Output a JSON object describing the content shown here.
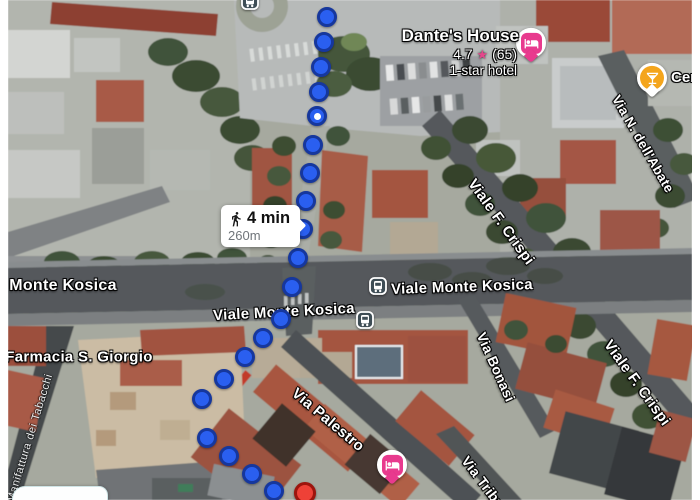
{
  "route": {
    "mode": "walking",
    "duration": "4 min",
    "distance": "260m",
    "dot_fill": "#2a5ff0",
    "dot_border": "#16379d",
    "white_center_dot_index": 4,
    "badge": {
      "x": 221,
      "y": 205
    },
    "dots": [
      [
        327,
        17
      ],
      [
        324,
        42
      ],
      [
        321,
        67
      ],
      [
        319,
        92
      ],
      [
        317,
        116
      ],
      [
        313,
        145
      ],
      [
        310,
        173
      ],
      [
        306,
        201
      ],
      [
        303,
        229
      ],
      [
        298,
        258
      ],
      [
        292,
        287
      ],
      [
        281,
        319
      ],
      [
        263,
        338
      ],
      [
        245,
        357
      ],
      [
        224,
        379
      ],
      [
        202,
        399
      ],
      [
        207,
        438
      ],
      [
        229,
        456
      ],
      [
        252,
        474
      ],
      [
        274,
        491
      ]
    ]
  },
  "destination": {
    "x": 305,
    "y": 493,
    "fill": "#ee4137",
    "border": "#9d140d"
  },
  "street_labels": [
    {
      "text": "Monte Kosica",
      "x": 63,
      "y": 286,
      "rot": 0,
      "size": 16,
      "variant": "road"
    },
    {
      "text": "Viale Monte Kosica",
      "x": 462,
      "y": 287,
      "rot": -2,
      "size": 15,
      "variant": "road"
    },
    {
      "text": "Viale Monte Kosica",
      "x": 284,
      "y": 312,
      "rot": -3,
      "size": 15,
      "variant": "road"
    },
    {
      "text": "Viale F. Crispi",
      "x": 501,
      "y": 222,
      "rot": 54,
      "size": 15,
      "variant": "road"
    },
    {
      "text": "Viale F. Crispi",
      "x": 637,
      "y": 383,
      "rot": 54,
      "size": 15,
      "variant": "road"
    },
    {
      "text": "Via N. dell'Abate",
      "x": 643,
      "y": 144,
      "rot": 60,
      "size": 13.5,
      "variant": "road"
    },
    {
      "text": "Via Bonasi",
      "x": 496,
      "y": 367,
      "rot": 66,
      "size": 14,
      "variant": "road"
    },
    {
      "text": "Via Palestro",
      "x": 328,
      "y": 420,
      "rot": 40,
      "size": 15,
      "variant": "road"
    },
    {
      "text": "Via Tribun",
      "x": 486,
      "y": 486,
      "rot": 53,
      "size": 14,
      "variant": "road"
    },
    {
      "text": "Farmacia S. Giorgio",
      "x": 79,
      "y": 357,
      "rot": 0,
      "size": 15,
      "variant": "road"
    },
    {
      "text": "Manifattura dei Tabacchi",
      "x": 30,
      "y": 438,
      "rot": -73,
      "size": 11,
      "variant": "minor"
    }
  ],
  "transit_stops": [
    {
      "x": 378,
      "y": 286
    },
    {
      "x": 365,
      "y": 320
    },
    {
      "x": 250,
      "y": 1
    }
  ],
  "markers": [
    {
      "type": "hotel",
      "x": 531,
      "y": 47
    },
    {
      "type": "hotel",
      "x": 392,
      "y": 469
    },
    {
      "type": "bar",
      "x": 652,
      "y": 82,
      "label": "Cer"
    }
  ],
  "pois": {
    "dantes_house": {
      "name": "Dante's House",
      "rating": "4.7",
      "rating_star": "★",
      "review_count": "(65)",
      "category": "1-star hotel"
    }
  },
  "colors": {
    "hotel_pink": "#e83a8e",
    "bar_orange": "#f4a51c",
    "star_pink": "#e5468c",
    "transit_fill": "#3e4d55",
    "destination_red": "#ee4137"
  }
}
